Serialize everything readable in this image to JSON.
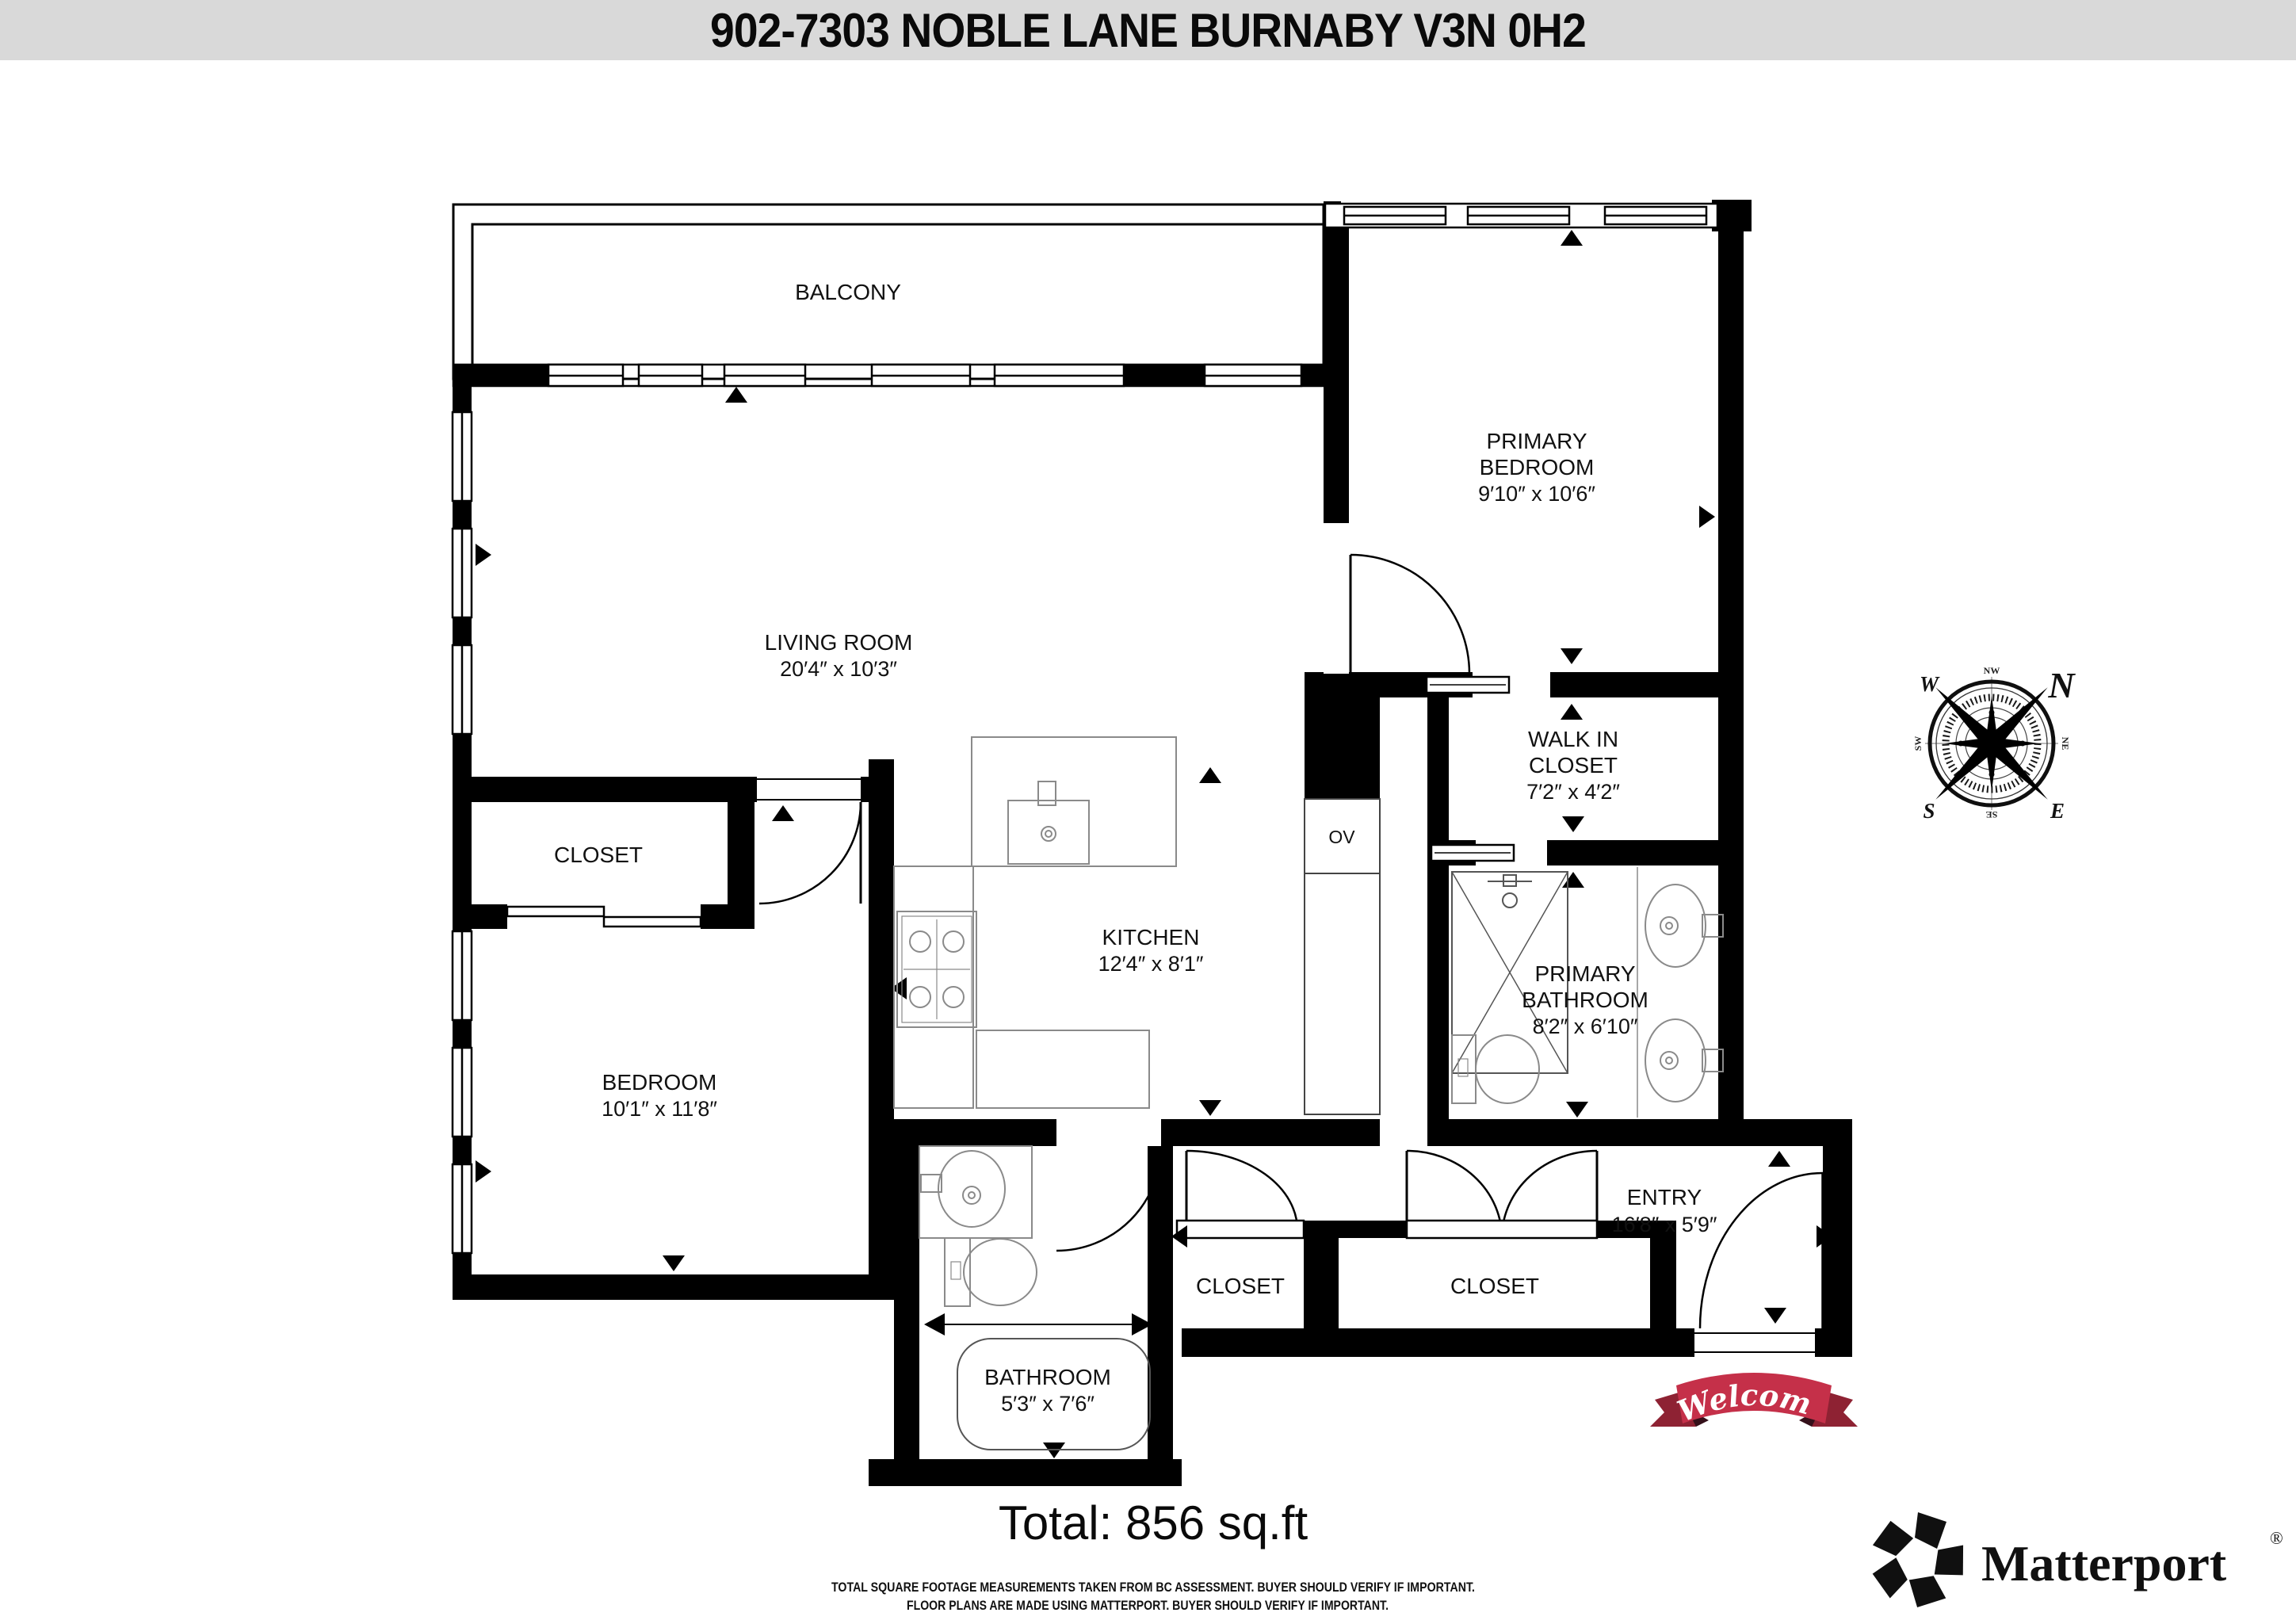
{
  "header": {
    "title": "902-7303 NOBLE LANE BURNABY V3N 0H2"
  },
  "rooms": {
    "balcony": {
      "name": "BALCONY"
    },
    "living_room": {
      "name": "LIVING ROOM",
      "dims": "20′4″ x 10′3″"
    },
    "primary_bedroom": {
      "name_line1": "PRIMARY",
      "name_line2": "BEDROOM",
      "dims": "9′10″ x 10′6″"
    },
    "walk_in_closet": {
      "name_line1": "WALK IN",
      "name_line2": "CLOSET",
      "dims": "7′2″ x 4′2″"
    },
    "kitchen": {
      "name": "KITCHEN",
      "dims": "12′4″ x 8′1″"
    },
    "primary_bathroom": {
      "name_line1": "PRIMARY",
      "name_line2": "BATHROOM",
      "dims": "8′2″ x 6′10″"
    },
    "bedroom": {
      "name": "BEDROOM",
      "dims": "10′1″ x 11′8″"
    },
    "bedroom_closet": {
      "name": "CLOSET"
    },
    "bathroom": {
      "name": "BATHROOM",
      "dims": "5′3″ x 7′6″"
    },
    "entry": {
      "name": "ENTRY",
      "dims": "16′8″ x 5′9″"
    },
    "entry_closet_small": {
      "name": "CLOSET"
    },
    "entry_closet_large": {
      "name": "CLOSET"
    },
    "oven": {
      "label": "OV"
    }
  },
  "compass": {
    "n": "N",
    "e": "E",
    "s": "S",
    "w": "W",
    "ne": "NE",
    "nw": "NW",
    "se": "SE",
    "sw": "SW"
  },
  "banner": {
    "text": "Welcome"
  },
  "footer": {
    "total": "Total: 856 sq.ft",
    "disclaimer_line1": "TOTAL SQUARE FOOTAGE MEASUREMENTS TAKEN FROM BC ASSESSMENT. BUYER SHOULD VERIFY IF IMPORTANT.",
    "disclaimer_line2": "FLOOR PLANS ARE MADE USING MATTERPORT. BUYER SHOULD VERIFY IF IMPORTANT."
  },
  "brand": {
    "name": "Matterport",
    "registered": "®"
  },
  "colors": {
    "header_bg": "#d9d9d9",
    "wall": "#000000",
    "fixture_stroke": "#8a8a8a",
    "banner_red": "#c53049",
    "banner_dark": "#8e2233",
    "banner_fold": "#35101a",
    "compass_north_red": "#c0392b"
  }
}
